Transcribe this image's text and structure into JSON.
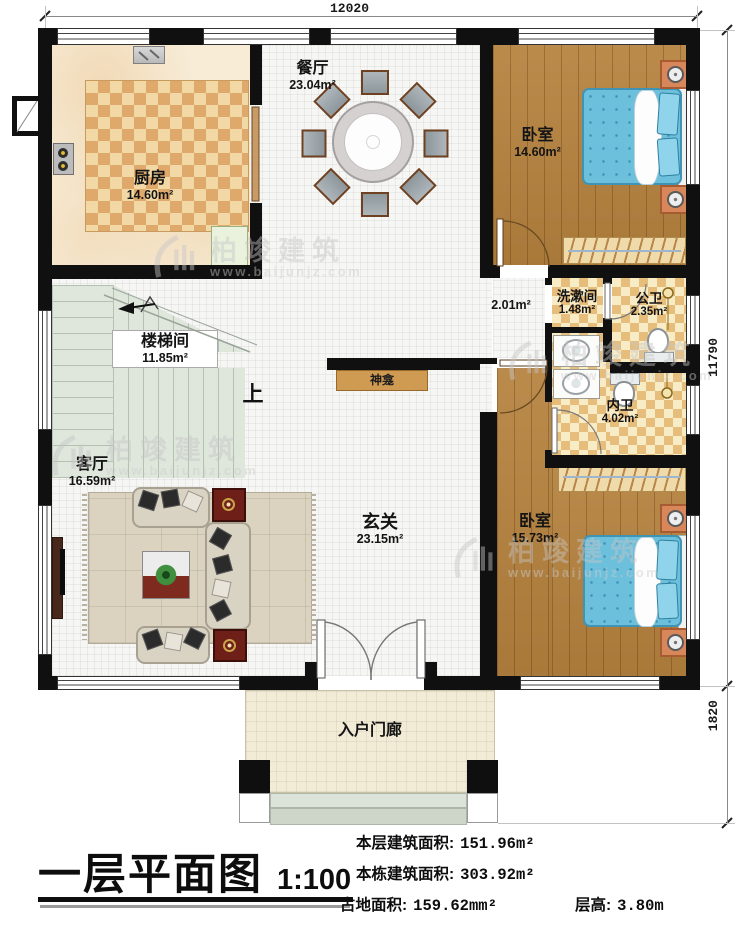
{
  "title_block": {
    "title": "一层平面图",
    "scale": "1:100"
  },
  "stats": {
    "items": [
      {
        "label": "本层建筑面积:",
        "value": "151.96m²"
      },
      {
        "label": "本栋建筑面积:",
        "value": "303.92m²"
      },
      {
        "label": "占地面积:",
        "value": "159.62mm²"
      },
      {
        "label": "层高:",
        "value": "3.80m"
      }
    ]
  },
  "dimensions": {
    "top": "12020",
    "right_upper": "11790",
    "right_lower": "1820"
  },
  "rooms": {
    "kitchen": {
      "name": "厨房",
      "area": "14.60m²"
    },
    "dining": {
      "name": "餐厅",
      "area": "23.04m²"
    },
    "bedroom_top": {
      "name": "卧室",
      "area": "14.60m²"
    },
    "stairwell": {
      "name": "楼梯间",
      "area": "11.85m²"
    },
    "washroom": {
      "name": "洗漱间",
      "area": "1.48m²"
    },
    "public_bath": {
      "name": "公卫",
      "area": "2.35m²"
    },
    "ensuite_bath": {
      "name": "内卫",
      "area": "4.02m²"
    },
    "living": {
      "name": "客厅",
      "area": "16.59m²"
    },
    "foyer": {
      "name": "玄关",
      "area": "23.15m²"
    },
    "bedroom_bottom": {
      "name": "卧室",
      "area": "15.73m²"
    },
    "corridor_area": "2.01m²",
    "shrine": "神龛",
    "porch": "入户门廊",
    "stairs_up": "上"
  },
  "watermark": {
    "brand": "柏竣建筑",
    "url": "www.baijunjz.com"
  },
  "colors": {
    "wall": "#101010",
    "wood_floor": "#b5823e",
    "checker_tan": "#e7bd7c",
    "bed_blue": "#6cc0dc",
    "stair_green": "#dfe6dc",
    "porch_cream": "#f2ecd6"
  }
}
